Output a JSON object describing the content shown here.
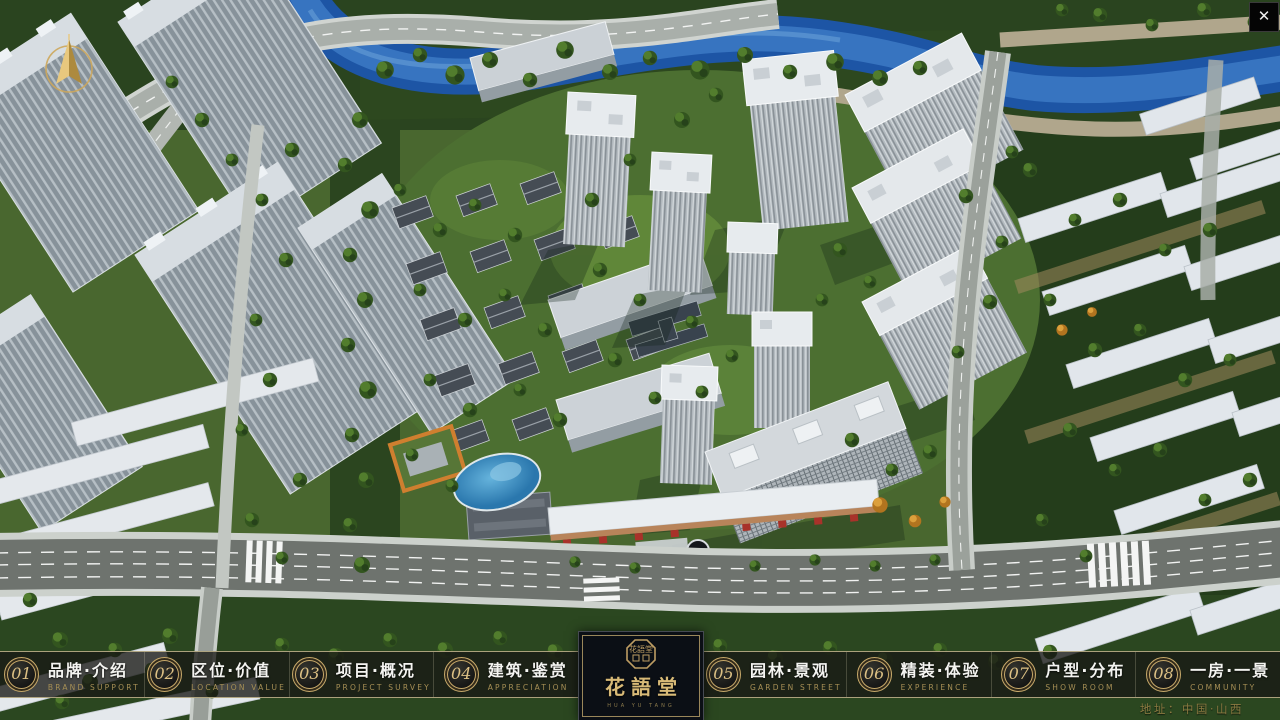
{
  "nav": {
    "items": [
      {
        "num": "01",
        "zh": "品牌·介绍",
        "en": "BRAND SUPPORT"
      },
      {
        "num": "02",
        "zh": "区位·价值",
        "en": "LOCATION VALUE"
      },
      {
        "num": "03",
        "zh": "项目·概况",
        "en": "PROJECT SURVEY"
      },
      {
        "num": "04",
        "zh": "建筑·鉴赏",
        "en": "APPRECIATION"
      },
      {
        "num": "05",
        "zh": "园林·景观",
        "en": "GARDEN STREET"
      },
      {
        "num": "06",
        "zh": "精装·体验",
        "en": "EXPERIENCE"
      },
      {
        "num": "07",
        "zh": "户型·分布",
        "en": "SHOW ROOM"
      },
      {
        "num": "08",
        "zh": "一房·一景",
        "en": "COMMUNITY"
      }
    ]
  },
  "logo": {
    "name": "花語堂",
    "seal_text": "花語堂",
    "sub": "HUA YU TANG"
  },
  "footer": {
    "address": "地址：中国·山西"
  },
  "icons": {
    "close": "✕",
    "compass": "north-arrow"
  },
  "colors": {
    "gold": "#c7a96a",
    "bar_border": "#c4b78e",
    "nav_en_text": "#a68f55",
    "address_text": "#8b7a41",
    "river_blue": "#1d55a5"
  }
}
